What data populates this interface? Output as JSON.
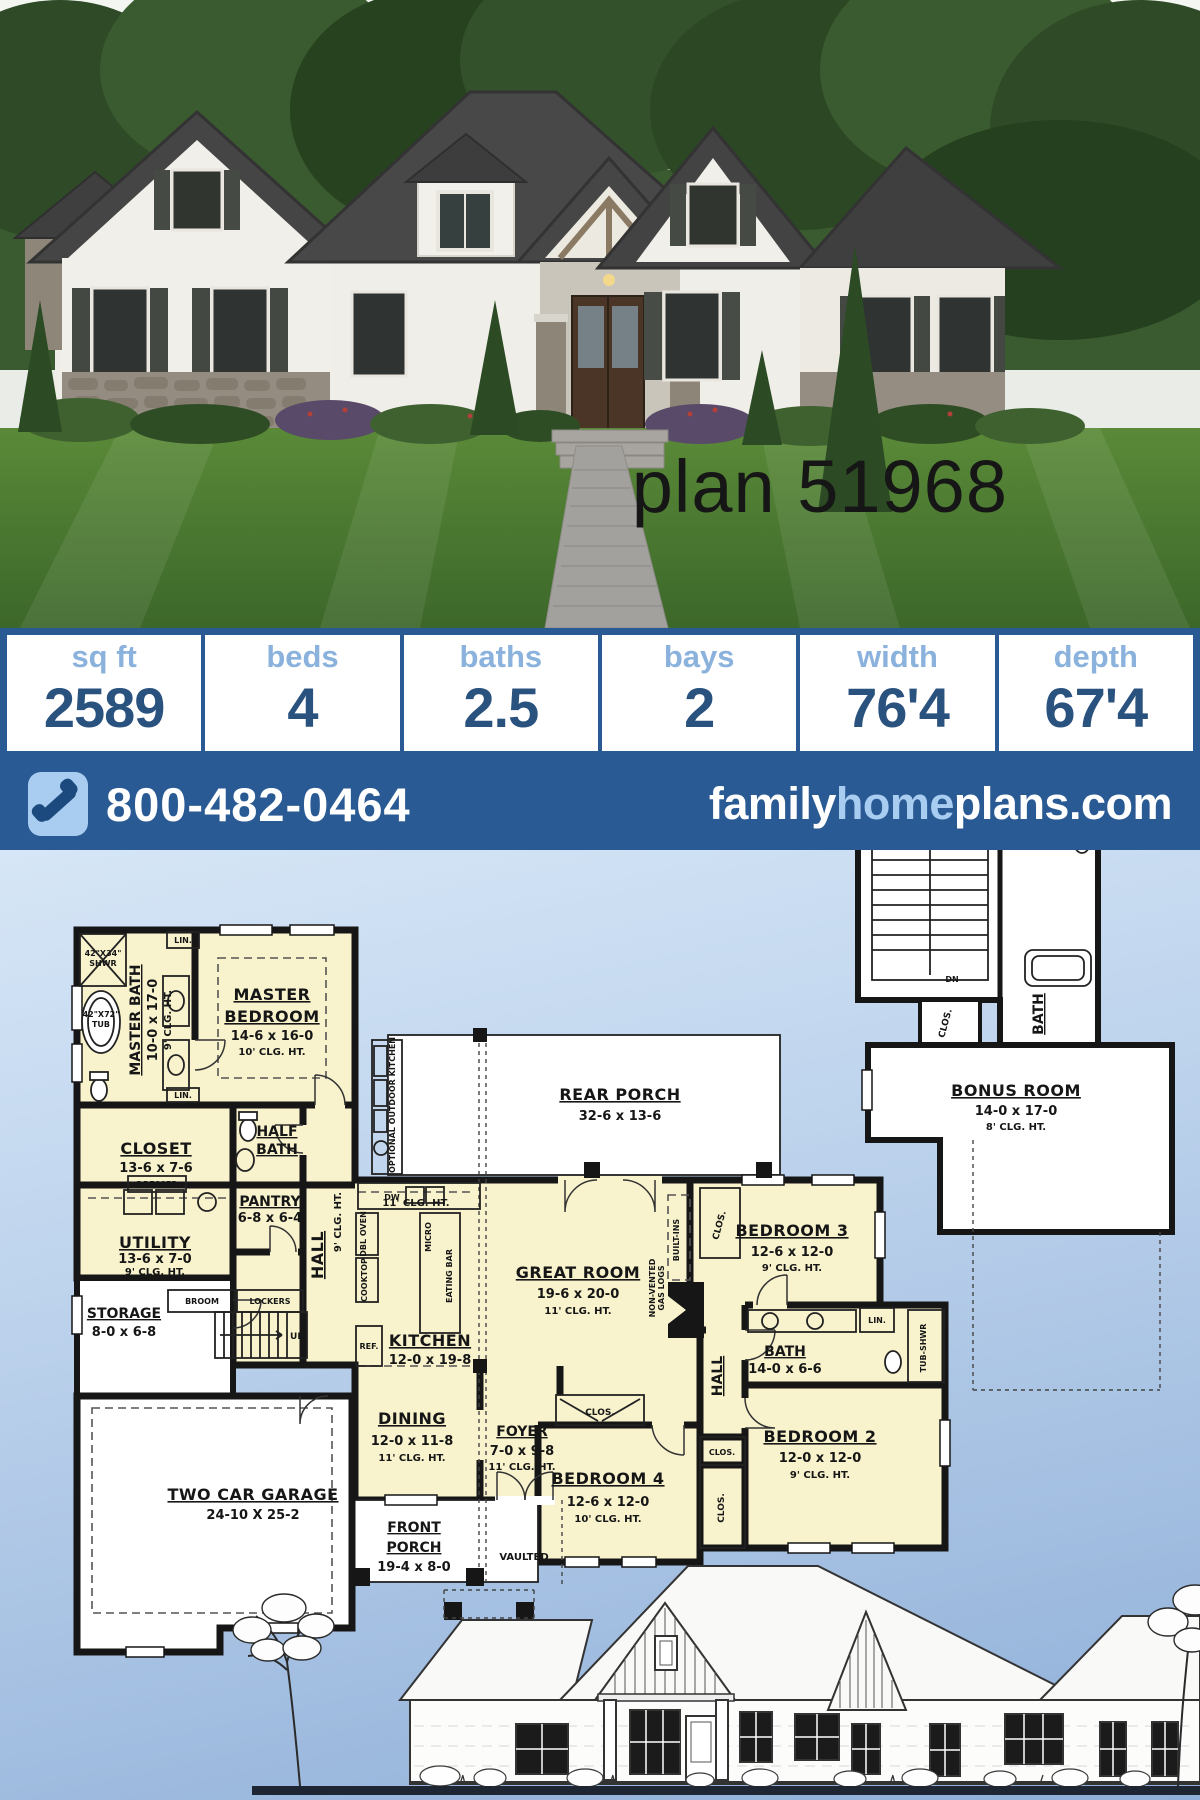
{
  "hero": {
    "plan_label": "plan 51968"
  },
  "stats": {
    "columns": [
      {
        "label": "sq ft",
        "value": "2589"
      },
      {
        "label": "beds",
        "value": "4"
      },
      {
        "label": "baths",
        "value": "2.5"
      },
      {
        "label": "bays",
        "value": "2"
      },
      {
        "label": "width",
        "value": "76'4"
      },
      {
        "label": "depth",
        "value": "67'4"
      }
    ]
  },
  "contact": {
    "phone": "800-482-0464",
    "website_family": "family",
    "website_home": "home",
    "website_plans": "plans",
    "website_tld": ".com"
  },
  "colors": {
    "brand_blue": "#2a5a94",
    "logo_light_blue": "#a9cdf1",
    "stat_label_blue": "#8ab2dc",
    "stat_value_navy": "#2a527f",
    "plan_room_yellow": "#f8f3cd",
    "plan_bg_top": "#d6e6f6",
    "plan_bg_bottom": "#8fafd8"
  },
  "floorplan": {
    "rooms": {
      "master_bath": {
        "name": "MASTER BATH",
        "dims": "10-0 x 17-0",
        "clg": "9' CLG. HT."
      },
      "master_bedroom": {
        "name1": "MASTER",
        "name2": "BEDROOM",
        "dims": "14-6 x 16-0",
        "clg": "10' CLG. HT."
      },
      "closet": {
        "name": "CLOSET",
        "dims": "13-6 x 7-6"
      },
      "half_bath": {
        "name1": "HALF",
        "name2": "BATH"
      },
      "pantry": {
        "name": "PANTRY",
        "dims": "6-8 x 6-4"
      },
      "utility": {
        "name": "UTILITY",
        "dims": "13-6 x 7-0",
        "clg": "9' CLG. HT."
      },
      "storage": {
        "name": "STORAGE",
        "dims": "8-0 x 6-8"
      },
      "hall_left": {
        "name": "HALL",
        "clg": "9' CLG. HT."
      },
      "kitchen": {
        "name": "KITCHEN",
        "dims": "12-0 x 19-8",
        "clg": "11' CLG. HT."
      },
      "dining": {
        "name": "DINING",
        "dims": "12-0 x 11-8",
        "clg": "11' CLG. HT."
      },
      "foyer": {
        "name": "FOYER",
        "dims": "7-0 x 9-8",
        "clg": "11' CLG. HT."
      },
      "front_porch": {
        "name1": "FRONT",
        "name2": "PORCH",
        "dims": "19-4 x 8-0"
      },
      "great_room": {
        "name": "GREAT ROOM",
        "dims": "19-6 x 20-0",
        "clg": "11' CLG. HT."
      },
      "rear_porch": {
        "name": "REAR PORCH",
        "dims": "32-6 x 13-6"
      },
      "garage": {
        "name": "TWO CAR GARAGE",
        "dims": "24-10 X 25-2"
      },
      "bedroom2": {
        "name": "BEDROOM 2",
        "dims": "12-0 x 12-0",
        "clg": "9' CLG. HT."
      },
      "bedroom3": {
        "name": "BEDROOM 3",
        "dims": "12-6 x 12-0",
        "clg": "9' CLG. HT."
      },
      "bedroom4": {
        "name": "BEDROOM 4",
        "dims": "12-6 x 12-0",
        "clg": "10' CLG. HT."
      },
      "bath": {
        "name": "BATH",
        "dims": "14-0 x 6-6"
      },
      "hall_right": {
        "name": "HALL"
      },
      "bonus_room": {
        "name": "BONUS ROOM",
        "dims": "14-0 x 17-0",
        "clg": "8' CLG. HT."
      },
      "bonus_bath": {
        "name": "BATH"
      }
    },
    "fixtures": {
      "shower_size": "42\"X34\"",
      "shower": "SHWR",
      "tub_size": "42\"X72\"",
      "tub": "TUB",
      "lin": "LIN.",
      "dresser": "DRESSER",
      "broom": "BROOM",
      "lockers": "LOCKERS",
      "up": "UP",
      "dn": "DN",
      "dw": "DW",
      "ref": "REF.",
      "clos": "CLOS.",
      "vaulted": "VAULTED",
      "micro": "MICRO",
      "eating_bar": "EATING BAR",
      "dbl_oven": "DBL OVEN",
      "cooktop": "COOKTOP",
      "outdoor_kitchen": "OPTIONAL OUTDOOR KITCHEN",
      "built_ins": "BUILT-INS",
      "gas_logs1": "NON-VENTED",
      "gas_logs2": "GAS LOGS",
      "tub_shwr": "TUB-SHWR"
    }
  }
}
